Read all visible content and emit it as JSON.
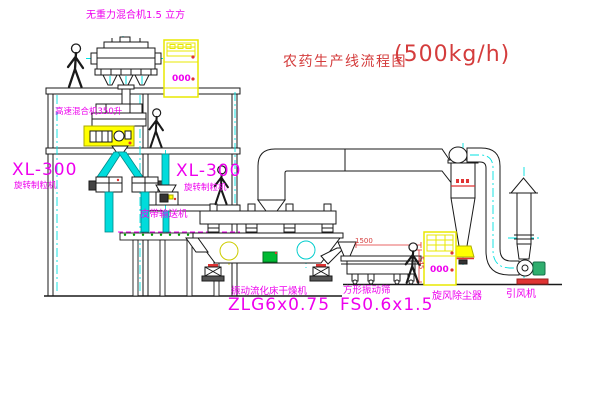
{
  "title": {
    "name": "农药生产线流程图",
    "capacity": "(500kg/h)"
  },
  "equipment": {
    "gravity_mixer": "无重力混合机1.5 立方",
    "high_speed_mixer": "高速混合机350升",
    "granulator_left_model": "XL-300",
    "granulator_left_name": "旋转制粒机",
    "granulator_right_model": "XL-300",
    "granulator_right_name": "旋转制粒机",
    "belt_conveyor": "皮带输送机",
    "fluid_bed_dryer_name": "振动流化床干燥机",
    "fluid_bed_dryer_model": "ZLG6x0.75",
    "vibrating_sieve_name": "方形振动筛",
    "vibrating_sieve_model": "FS0.6x1.5",
    "cyclone": "旋风除尘器",
    "induced_draft_fan": "引风机"
  },
  "dimensions": {
    "sieve_length": "1500",
    "sieve_height": "545"
  },
  "cabinets": {
    "display": "000"
  },
  "colors": {
    "label_magenta": "#ee00ee",
    "title_red": "#d43c3c",
    "centerline_cyan": "#00e0e0",
    "duct_fill_cyan": "#00dcdc",
    "highlight_yellow": "#ffff00",
    "accent_red": "#e03333",
    "machine_green": "#00bb33"
  }
}
